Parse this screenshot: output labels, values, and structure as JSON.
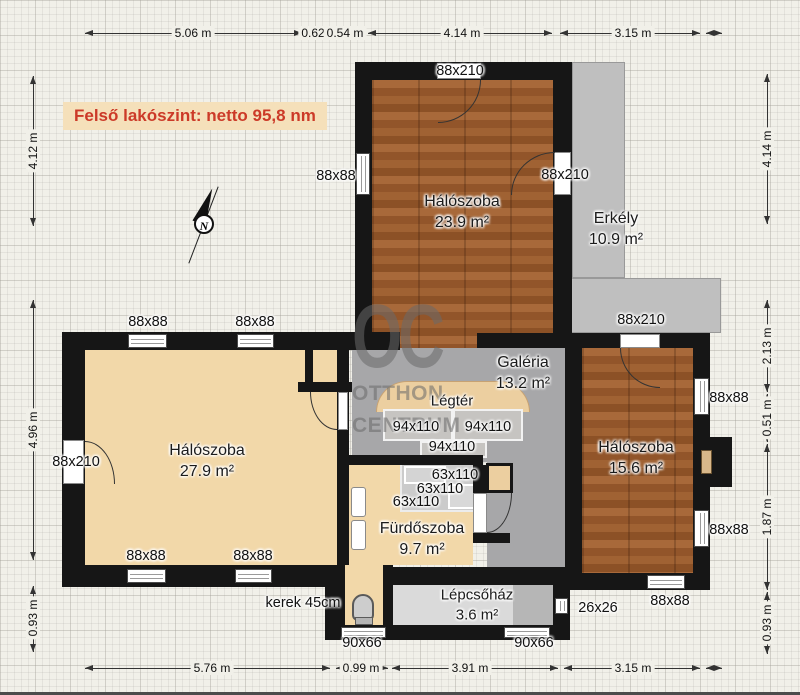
{
  "title": "Felső lakószint: netto 95,8 nm",
  "watermark": {
    "monogram": "OC",
    "line1": "OTTHON",
    "line2": "CENTRUM"
  },
  "compass": {
    "letter": "N"
  },
  "rooms": {
    "bedroom_top": {
      "name": "Hálószoba",
      "area": "23.9 m²"
    },
    "balcony": {
      "name": "Erkély",
      "area": "10.9 m²"
    },
    "bedroom_left": {
      "name": "Hálószoba",
      "area": "27.9 m²"
    },
    "gallery": {
      "name": "Galéria",
      "area": "13.2 m²"
    },
    "airspace": {
      "name": "Légtér"
    },
    "bedroom_right": {
      "name": "Hálószoba",
      "area": "15.6 m²"
    },
    "bathroom": {
      "name": "Fürdőszoba",
      "area": "9.7 m²"
    },
    "staircase": {
      "name": "Lépcsőház",
      "area": "3.6 m²"
    }
  },
  "openings": [
    {
      "label": "88x210"
    },
    {
      "label": "88x88"
    },
    {
      "label": "88x210"
    },
    {
      "label": "88x210"
    },
    {
      "label": "88x88"
    },
    {
      "label": "88x88"
    },
    {
      "label": "88x210"
    },
    {
      "label": "94x110"
    },
    {
      "label": "94x110"
    },
    {
      "label": "94x110"
    },
    {
      "label": "63x110"
    },
    {
      "label": "63x110"
    },
    {
      "label": "63x110"
    },
    {
      "label": "88x88"
    },
    {
      "label": "88x88"
    },
    {
      "label": "88x88"
    },
    {
      "label": "88x88"
    },
    {
      "label": "88x88"
    },
    {
      "label": "26x26"
    },
    {
      "label": "90x66"
    },
    {
      "label": "90x66"
    },
    {
      "label": "kerek 45cm"
    }
  ],
  "dims": {
    "top": [
      "5.06 m",
      "0.62",
      "0.54 m",
      "4.14 m",
      "3.15 m"
    ],
    "bottom": [
      "5.76 m",
      "0.99 m",
      "3.91 m",
      "3.15 m"
    ],
    "left": [
      "4.12 m",
      "4.96 m",
      "0.93 m"
    ],
    "right": [
      "4.14 m",
      "2.13 m",
      "0.51 m",
      "1.87 m",
      "0.93 m"
    ]
  }
}
